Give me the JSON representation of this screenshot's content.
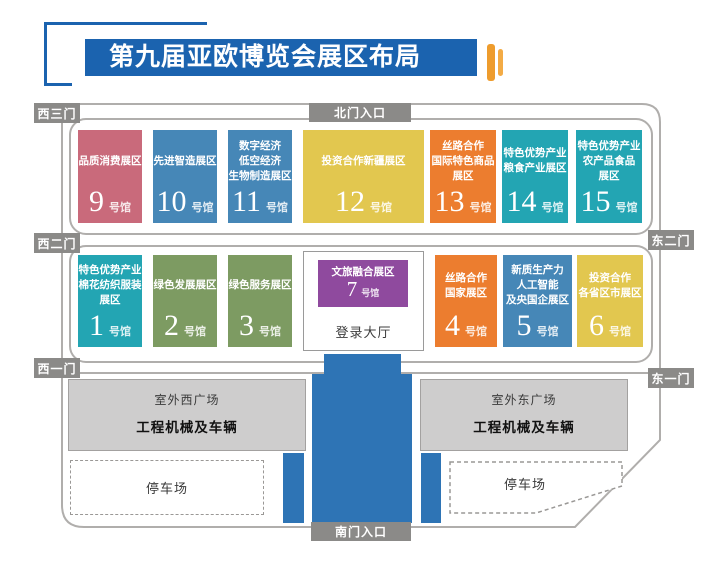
{
  "title": {
    "text": "第九届亚欧博览会展区布局"
  },
  "gates": {
    "north": "北门入口",
    "south": "南门入口",
    "west3": "西三门",
    "west2": "西二门",
    "west1": "西一门",
    "east2": "东二门",
    "east1": "东一门"
  },
  "hall_suffix": "号馆",
  "halls": [
    {
      "id": "9",
      "lines": [
        "品质消费展区"
      ],
      "color": "#c96a7b"
    },
    {
      "id": "10",
      "lines": [
        "先进智造展区"
      ],
      "color": "#4687b7"
    },
    {
      "id": "11",
      "lines": [
        "数字经济",
        "低空经济",
        "生物制造展区"
      ],
      "color": "#4687b7"
    },
    {
      "id": "12",
      "lines": [
        "投资合作新疆展区"
      ],
      "color": "#e2c74f"
    },
    {
      "id": "13",
      "lines": [
        "丝路合作",
        "国际特色商品",
        "展区"
      ],
      "color": "#ec7d2f"
    },
    {
      "id": "14",
      "lines": [
        "特色优势产业",
        "粮食产业展区"
      ],
      "color": "#23a5b3"
    },
    {
      "id": "15",
      "lines": [
        "特色优势产业",
        "农产品食品",
        "展区"
      ],
      "color": "#23a5b3"
    },
    {
      "id": "1",
      "lines": [
        "特色优势产业",
        "棉花纺织服装",
        "展区"
      ],
      "color": "#23a5b3"
    },
    {
      "id": "2",
      "lines": [
        "绿色发展展区"
      ],
      "color": "#7d9b62"
    },
    {
      "id": "3",
      "lines": [
        "绿色服务展区"
      ],
      "color": "#7d9b62"
    },
    {
      "id": "4",
      "lines": [
        "丝路合作",
        "国家展区"
      ],
      "color": "#ec7d2f"
    },
    {
      "id": "5",
      "lines": [
        "新质生产力",
        "人工智能",
        "及央国企展区"
      ],
      "color": "#4687b7"
    },
    {
      "id": "6",
      "lines": [
        "投资合作",
        "各省区市展区"
      ],
      "color": "#e2c74f"
    }
  ],
  "center": {
    "hall7": {
      "id": "7",
      "lines": [
        "文旅融合展区"
      ],
      "color": "#8f4a9e"
    },
    "lobby": "登录大厅"
  },
  "south": {
    "west_plaza": {
      "name": "室外西广场",
      "content": "工程机械及车辆"
    },
    "east_plaza": {
      "name": "室外东广场",
      "content": "工程机械及车辆"
    },
    "west_parking": "停车场",
    "east_parking": "停车场"
  },
  "colors": {
    "banner": "#1b63af",
    "corridor": "#2e74b5",
    "gate": "#8b8a88",
    "road": "#b0aeac",
    "plaza": "#cecdcd",
    "accent_orange": "#ef9d2f"
  }
}
